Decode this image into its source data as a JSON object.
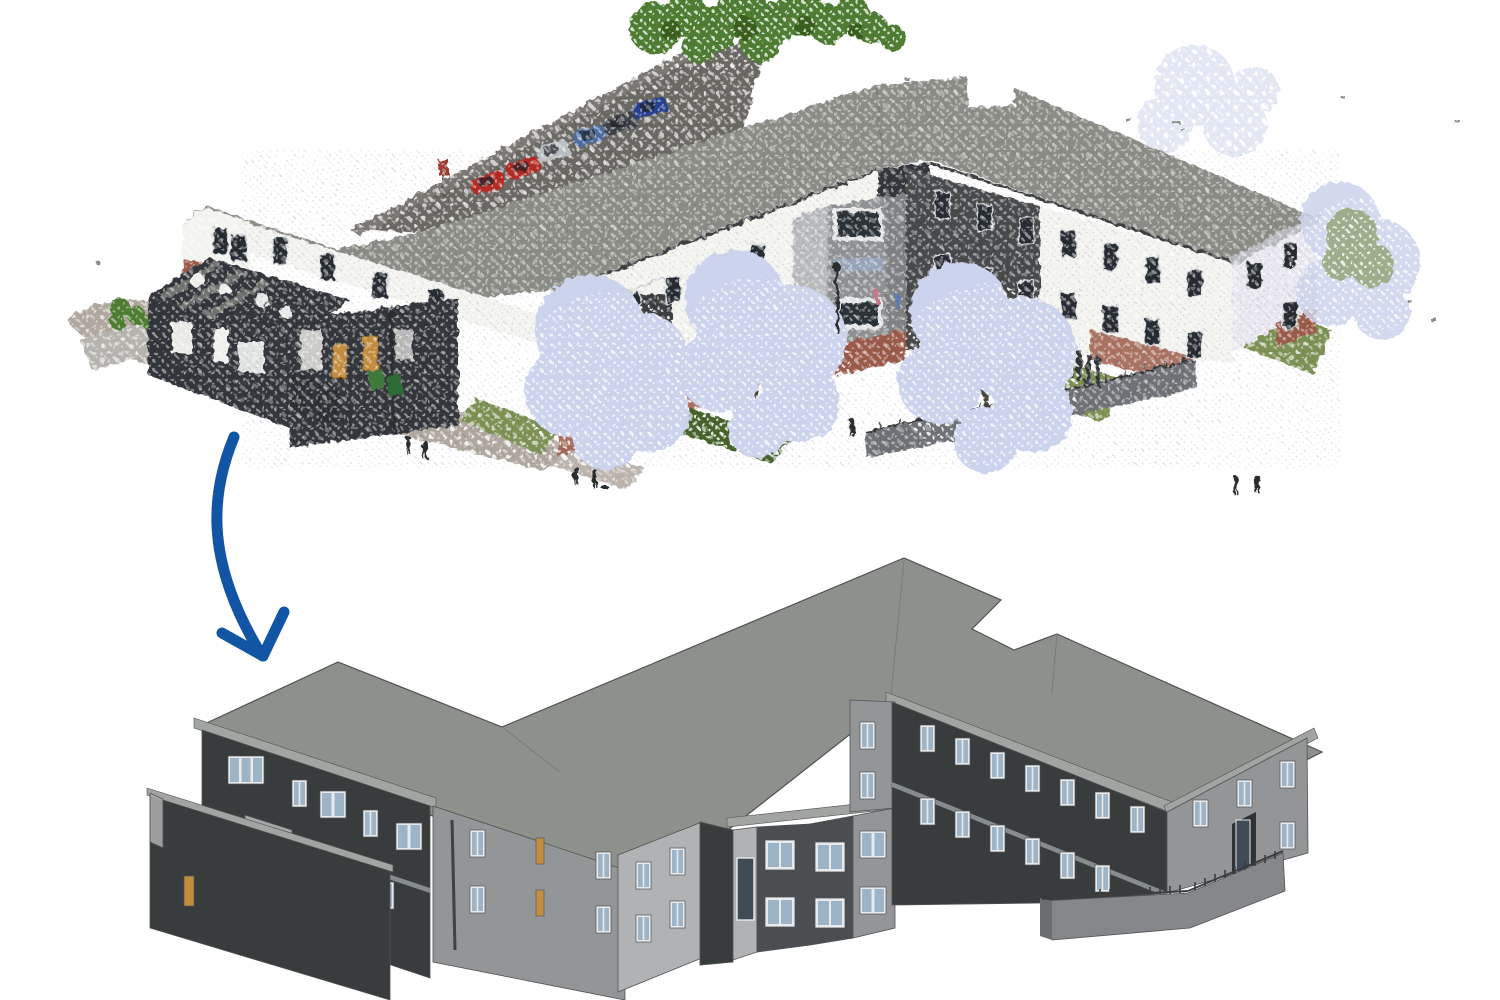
{
  "figure": {
    "description": "Scan-to-BIM illustration: a colored 3D laser-scan point cloud of a two-storey residential care building is transformed (blue arrow) into a clean grey BIM model of the same building",
    "top": {
      "label": "3D point cloud scan of building with site context",
      "type": "point-cloud",
      "features": {
        "parking_cars": 6,
        "car_colors": [
          "red",
          "red",
          "silver",
          "steel-blue",
          "dark-grey",
          "navy-blue"
        ],
        "large_pale_trees": 3,
        "green_trees_back": 1,
        "people_figures": 7,
        "street_lamps": 2,
        "waste_bins": 2,
        "has_access_ramp": true,
        "wall_finishes": [
          "white render",
          "dark cladding",
          "red brick"
        ]
      }
    },
    "arrow": {
      "label": "conversion arrow from scan to model",
      "direction": "down",
      "style": "hand-drawn curved"
    },
    "bottom": {
      "label": "BIM model of the same building",
      "type": "bim-model",
      "features": {
        "storeys": 2,
        "flat_roof": true,
        "walled_courtyard": true,
        "orange_doors": 4,
        "access_ramp_with_railing": true,
        "bay_window_block": true
      }
    }
  },
  "palette": {
    "bg": "#ffffff",
    "arrow": "#1155a4",
    "bim-roof": "#8e908b",
    "bim-roof-line": "#6f716d",
    "bim-fascia": "#a2a4a1",
    "bim-wall-dark": "#393c3d",
    "bim-wall-mid": "#4b4e50",
    "bim-wall-light": "#939597",
    "bim-wall-lighter": "#b0b2b4",
    "bim-inner": "#a6a8aa",
    "bim-frame": "#e8eaec",
    "bim-glass": "#9db4c6",
    "bim-glass-dark": "#3f4c57",
    "bim-door": "#c28d3e",
    "bim-outline": "#4f5254",
    "bim-band": "#8f9396",
    "bim-ramp": "#85878a",
    "bim-rail": "#3a3c3e",
    "scan-roof": "#8a8c85",
    "scan-wall-white": "#f3f3ef",
    "scan-wall-dark": "#33363a",
    "scan-wall-gray": "#8f9193",
    "scan-brick": "#9b5a49",
    "scan-window": "#252b31",
    "scan-frame": "#d7dadd",
    "scan-asphalt": "#6b6763",
    "scan-road": "#b0a79e",
    "scan-grass": "#7c9152",
    "scan-tree-pale": "#ccd3ec",
    "scan-tree-green": "#4e7c31",
    "scan-trunk": "#4a4742",
    "scan-person": "#2b2d2f",
    "scan-lamp": "#2b2d2f",
    "car-red": "#b22a22",
    "car-silver": "#b9bec2",
    "car-blue": "#4c6ba0",
    "car-dark": "#3a3f46",
    "car-navy": "#27408f"
  }
}
